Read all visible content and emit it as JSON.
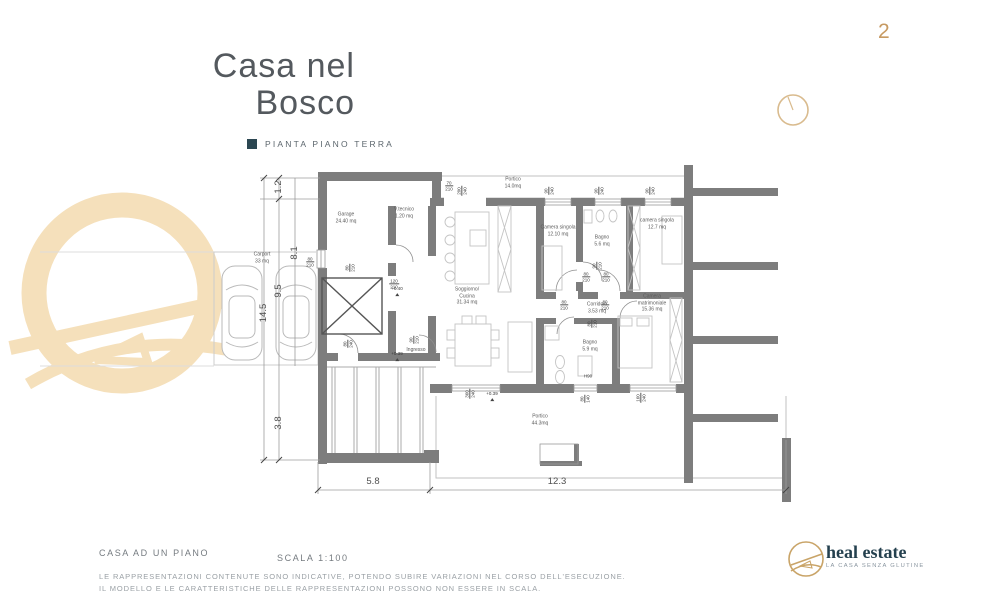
{
  "page": {
    "number": "2"
  },
  "title": {
    "line1": "Casa nel",
    "line2": "Bosco"
  },
  "legend": {
    "label": "PIANTA PIANO TERRA"
  },
  "footer": {
    "plan_type": "CASA AD UN PIANO",
    "scale": "SCALA 1:100",
    "disclaimer1": "LE RAPPRESENTAZIONI CONTENUTE SONO INDICATIVE, POTENDO SUBIRE VARIAZIONI NEL CORSO DELL'ESECUZIONE.",
    "disclaimer2": "IL MODELLO E LE CARATTERISTICHE DELLE RAPPRESENTAZIONI POSSONO NON ESSERE IN SCALA."
  },
  "logo": {
    "name": "heal estate",
    "tagline": "LA CASA SENZA GLUTINE"
  },
  "colors": {
    "accent_gold": "#c79a62",
    "watermark_tan": "#f5e0bb",
    "legend_square": "#2c4752",
    "wall_gray": "#7d7d7d",
    "brand_dark": "#24404e"
  },
  "plan": {
    "rooms": [
      {
        "lines": [
          "Garage",
          "24.40 mq"
        ],
        "x": 346,
        "y": 218
      },
      {
        "lines": [
          "V.tecnico",
          "1.20 mq"
        ],
        "x": 404,
        "y": 213
      },
      {
        "lines": [
          "Portico",
          "14.0mq"
        ],
        "x": 513,
        "y": 183
      },
      {
        "lines": [
          "Camera singola",
          "12.10 mq"
        ],
        "x": 558,
        "y": 231
      },
      {
        "lines": [
          "Bagno",
          "5.6 mq"
        ],
        "x": 602,
        "y": 241
      },
      {
        "lines": [
          "camera singola",
          "12.7 mq"
        ],
        "x": 657,
        "y": 224
      },
      {
        "lines": [
          "Soggiorno/",
          "Cucina",
          "31.34 mq"
        ],
        "x": 467,
        "y": 296
      },
      {
        "lines": [
          "Corridoio",
          "3.53 mq"
        ],
        "x": 597,
        "y": 308
      },
      {
        "lines": [
          "Bagno",
          "5.9 mq"
        ],
        "x": 590,
        "y": 346
      },
      {
        "lines": [
          "Camera",
          "matrimoniale",
          "15.36 mq"
        ],
        "x": 652,
        "y": 303
      },
      {
        "lines": [
          "Carport",
          "33 mq"
        ],
        "x": 262,
        "y": 258
      },
      {
        "lines": [
          "Portico",
          "44.3mq"
        ],
        "x": 540,
        "y": 420
      },
      {
        "lines": [
          "Ingresso"
        ],
        "x": 416,
        "y": 350
      }
    ],
    "dims": [
      {
        "lines": [
          "70",
          "210"
        ],
        "x": 449,
        "y": 186
      },
      {
        "lines": [
          "200",
          "240"
        ],
        "x": 462,
        "y": 191,
        "rot": 1
      },
      {
        "lines": [
          "90",
          "240"
        ],
        "x": 549,
        "y": 191,
        "rot": 1
      },
      {
        "lines": [
          "90",
          "240"
        ],
        "x": 599,
        "y": 191,
        "rot": 1
      },
      {
        "lines": [
          "90",
          "240"
        ],
        "x": 650,
        "y": 191,
        "rot": 1
      },
      {
        "lines": [
          "80",
          "210"
        ],
        "x": 310,
        "y": 262
      },
      {
        "lines": [
          "80",
          "210"
        ],
        "x": 350,
        "y": 268,
        "rot": 1
      },
      {
        "lines": [
          "120",
          "210"
        ],
        "x": 394,
        "y": 284
      },
      {
        "lines": [
          "80",
          "240"
        ],
        "x": 348,
        "y": 344,
        "rot": 1
      },
      {
        "lines": [
          "90",
          "210"
        ],
        "x": 414,
        "y": 340,
        "rot": 1
      },
      {
        "lines": [
          "90",
          "210"
        ],
        "x": 597,
        "y": 266,
        "rot": 1
      },
      {
        "lines": [
          "80",
          "210"
        ],
        "x": 586,
        "y": 277
      },
      {
        "lines": [
          "80",
          "210"
        ],
        "x": 606,
        "y": 277
      },
      {
        "lines": [
          "80",
          "210"
        ],
        "x": 564,
        "y": 305
      },
      {
        "lines": [
          "80",
          "210"
        ],
        "x": 605,
        "y": 305
      },
      {
        "lines": [
          "80",
          "210"
        ],
        "x": 592,
        "y": 324,
        "rot": 1
      },
      {
        "lines": [
          "360",
          "240"
        ],
        "x": 470,
        "y": 394,
        "rot": 1
      },
      {
        "lines": [
          "H90"
        ],
        "x": 588,
        "y": 376
      },
      {
        "lines": [
          "80",
          "140"
        ],
        "x": 585,
        "y": 399,
        "rot": 1
      },
      {
        "lines": [
          "160",
          "240"
        ],
        "x": 641,
        "y": 398,
        "rot": 1
      }
    ],
    "levels": [
      {
        "t": "+0.40",
        "x": 397,
        "y": 291
      },
      {
        "t": "+0.39",
        "x": 397,
        "y": 356
      },
      {
        "t": "+0.39",
        "x": 492,
        "y": 396
      }
    ],
    "chain_left": [
      {
        "t": "1.2",
        "x": 279,
        "y": 187,
        "rot": 1
      },
      {
        "t": "8.1",
        "x": 295,
        "y": 253,
        "rot": 1
      },
      {
        "t": "9.5",
        "x": 279,
        "y": 291,
        "rot": 1
      },
      {
        "t": "14.5",
        "x": 264,
        "y": 313,
        "rot": 1
      },
      {
        "t": "3.8",
        "x": 279,
        "y": 423,
        "rot": 1
      }
    ],
    "chain_bottom": [
      {
        "t": "5.8",
        "x": 373,
        "y": 482
      },
      {
        "t": "12.3",
        "x": 557,
        "y": 482
      }
    ]
  }
}
